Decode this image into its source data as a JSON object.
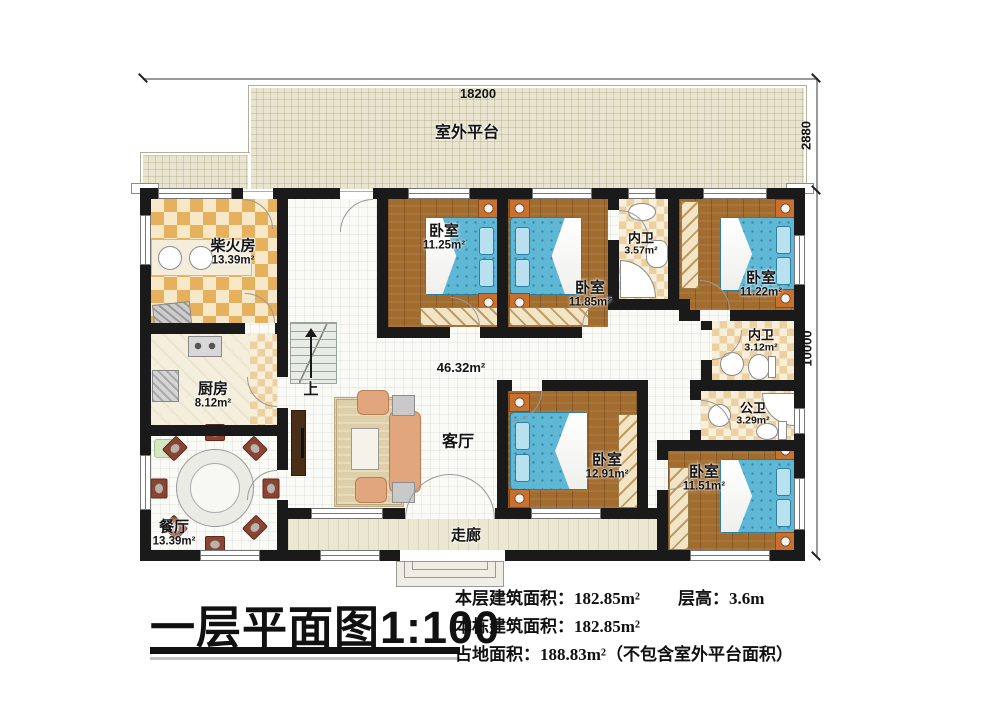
{
  "plan": {
    "outdoor_platform": {
      "name": "室外平台"
    },
    "rooms": {
      "firewood": {
        "name": "柴火房",
        "area": "13.39m²"
      },
      "kitchen": {
        "name": "厨房",
        "area": "8.12m²"
      },
      "dining": {
        "name": "餐厅",
        "area": "13.39m²"
      },
      "living": {
        "name": "客厅",
        "area": "46.32m²"
      },
      "bedroom1": {
        "name": "卧室",
        "area": "11.25m²"
      },
      "bedroom2": {
        "name": "卧室",
        "area": "11.85m²"
      },
      "bath1": {
        "name": "内卫",
        "area": "3.57m²"
      },
      "bedroom3": {
        "name": "卧室",
        "area": "11.22m²"
      },
      "bath2": {
        "name": "内卫",
        "area": "3.12m²"
      },
      "bath3": {
        "name": "公卫",
        "area": "3.29m²"
      },
      "bedroom4": {
        "name": "卧室",
        "area": "12.91m²"
      },
      "bedroom5": {
        "name": "卧室",
        "area": "11.51m²"
      },
      "corridor": {
        "name": "走廊"
      }
    },
    "stairs": {
      "label": "上"
    },
    "dimensions": {
      "top": "18200",
      "right_upper": "2880",
      "right_lower": "10000"
    }
  },
  "title_block": {
    "title": "一层平面图",
    "scale": "1:100",
    "stats": {
      "line1_label": "本层建筑面积：",
      "line1_value": "182.85m²",
      "height_label": "层高：",
      "height_value": "3.6m",
      "line2_label": "本栋建筑面积：",
      "line2_value": "182.85m²",
      "line3_label": "占地面积：",
      "line3_value": "188.83m²",
      "line3_note": "（不包含室外平台面积）"
    }
  },
  "colors": {
    "wall": "#1a1a1a",
    "wood_floor": "#a26c2e",
    "bed": "#5fb7d6",
    "checker": "#e7b05c",
    "platform": "#e9e4cf",
    "corridor": "#ece7d2"
  }
}
